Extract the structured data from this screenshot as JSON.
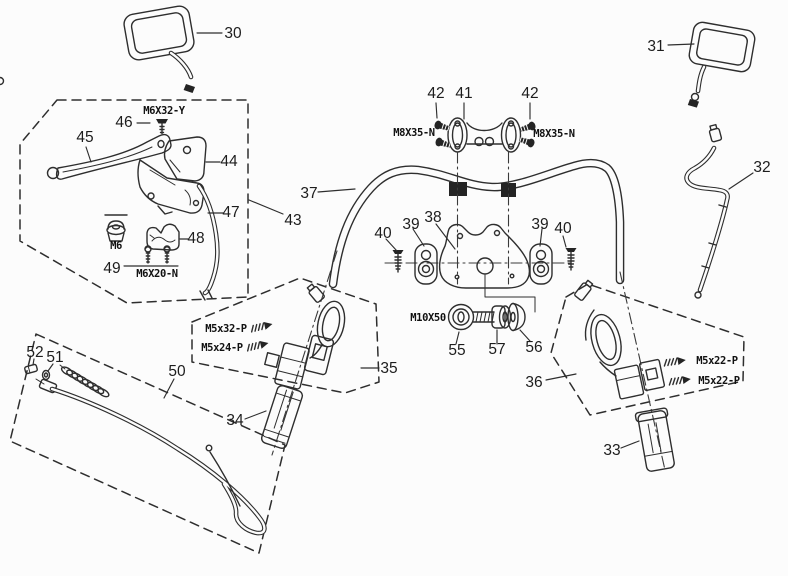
{
  "diagram": {
    "title": "handlebar-assembly-exploded-parts-diagram",
    "colors": {
      "background": "#fcfcfc",
      "line": "#2e2e2e",
      "label": "#1d1d1d"
    },
    "callouts": [
      {
        "id": "30",
        "x": 233,
        "y": 38
      },
      {
        "id": "31",
        "x": 656,
        "y": 51
      },
      {
        "id": "32",
        "x": 762,
        "y": 172
      },
      {
        "id": "33",
        "x": 612,
        "y": 455
      },
      {
        "id": "34",
        "x": 235,
        "y": 425
      },
      {
        "id": "35",
        "x": 389,
        "y": 373
      },
      {
        "id": "36",
        "x": 534,
        "y": 387
      },
      {
        "id": "37",
        "x": 309,
        "y": 198
      },
      {
        "id": "38",
        "x": 433,
        "y": 222
      },
      {
        "id": "39",
        "x": 411,
        "y": 229
      },
      {
        "id": "39",
        "x": 540,
        "y": 229
      },
      {
        "id": "40",
        "x": 383,
        "y": 238
      },
      {
        "id": "40",
        "x": 563,
        "y": 233
      },
      {
        "id": "41",
        "x": 464,
        "y": 98
      },
      {
        "id": "42",
        "x": 436,
        "y": 98
      },
      {
        "id": "42",
        "x": 530,
        "y": 98
      },
      {
        "id": "43",
        "x": 293,
        "y": 225
      },
      {
        "id": "44",
        "x": 229,
        "y": 166
      },
      {
        "id": "45",
        "x": 85,
        "y": 142
      },
      {
        "id": "46",
        "x": 124,
        "y": 127
      },
      {
        "id": "47",
        "x": 231,
        "y": 217
      },
      {
        "id": "48",
        "x": 196,
        "y": 243
      },
      {
        "id": "49",
        "x": 112,
        "y": 273
      },
      {
        "id": "50",
        "x": 177,
        "y": 376
      },
      {
        "id": "51",
        "x": 55,
        "y": 362
      },
      {
        "id": "52",
        "x": 35,
        "y": 357
      },
      {
        "id": "55",
        "x": 457,
        "y": 355
      },
      {
        "id": "56",
        "x": 534,
        "y": 352
      },
      {
        "id": "57",
        "x": 497,
        "y": 354
      }
    ],
    "spec_labels": [
      {
        "text": "M6X32-Y",
        "x": 164,
        "y": 114
      },
      {
        "text": "M6",
        "x": 116,
        "y": 249
      },
      {
        "text": "M6X20-N",
        "x": 157,
        "y": 277
      },
      {
        "text": "M8X35-N",
        "x": 414,
        "y": 136
      },
      {
        "text": "M8X35-N",
        "x": 554,
        "y": 137
      },
      {
        "text": "M10X50",
        "x": 428,
        "y": 321
      },
      {
        "text": "M5x32-P",
        "x": 226,
        "y": 332
      },
      {
        "text": "M5x24-P",
        "x": 222,
        "y": 351
      },
      {
        "text": "M5x22-P",
        "x": 717,
        "y": 364
      },
      {
        "text": "M5x22-P",
        "x": 719,
        "y": 384
      }
    ]
  }
}
